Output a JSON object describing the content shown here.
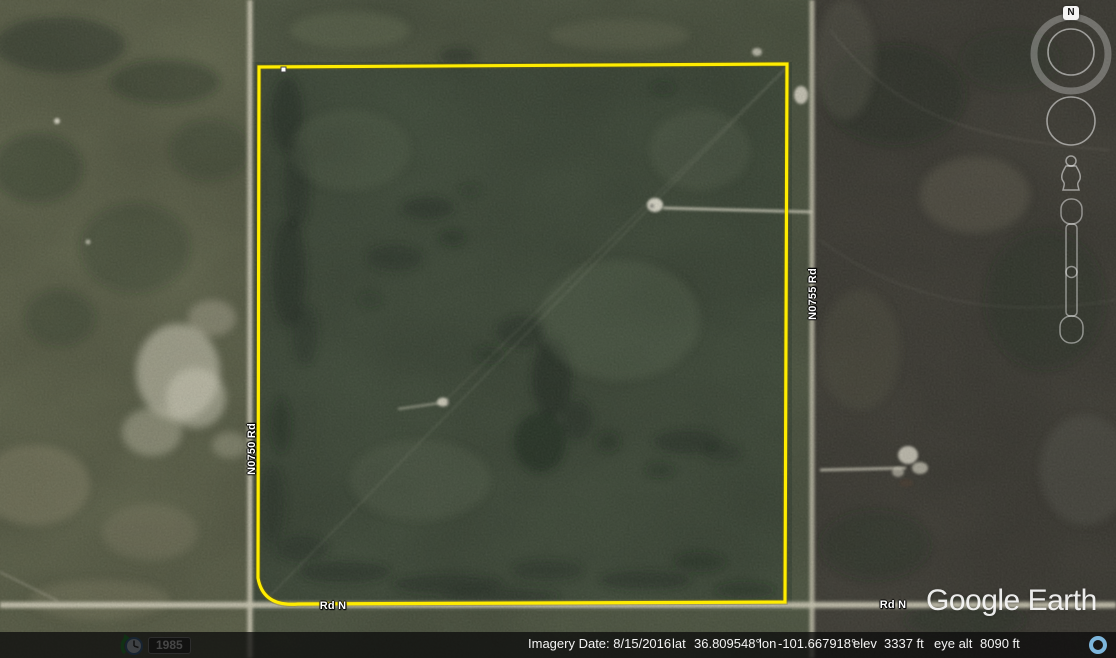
{
  "map": {
    "labels": {
      "road_left": "N0750 Rd",
      "road_right": "N0755 Rd",
      "road_bottom_left": "Rd N",
      "road_bottom_right": "Rd N"
    },
    "colors": {
      "boundary_yellow": "#ffec00",
      "status_ring_blue": "#7db6dc"
    }
  },
  "navigation": {
    "north_label": "N"
  },
  "time_control": {
    "year": "1985"
  },
  "status_bar": {
    "imagery_date_label": "Imagery Date:",
    "imagery_date": "8/15/2016",
    "lat_label": "lat",
    "lat": "36.809548°",
    "lon_label": "lon",
    "lon": "-101.667918°",
    "elev_label": "elev",
    "elev": "3337 ft",
    "eye_alt_label": "eye alt",
    "eye_alt": "8090 ft"
  },
  "branding": {
    "logo_text": "Google Earth"
  }
}
